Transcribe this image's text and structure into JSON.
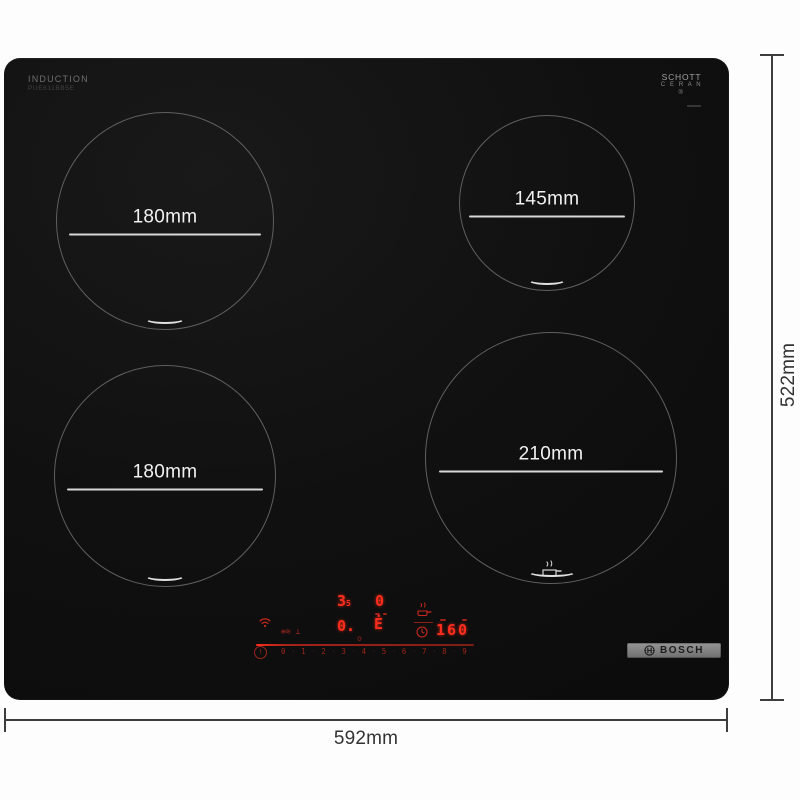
{
  "branding": {
    "induction": "INDUCTION",
    "model": "PUE611BB5E",
    "schott_line1": "SCHOTT",
    "schott_line2": "C E R A N ®",
    "bosch": "BOSCH"
  },
  "dimensions": {
    "width_label": "592mm",
    "height_label": "522mm"
  },
  "zones": [
    {
      "position": "top-left",
      "label": "180mm"
    },
    {
      "position": "top-right",
      "label": "145mm"
    },
    {
      "position": "bottom-left",
      "label": "180mm"
    },
    {
      "position": "bottom-right",
      "label": "210mm"
    }
  ],
  "display": {
    "burner_a_value": "3",
    "burner_a_sub": "5",
    "burner_b_value": "0",
    "burner_c_value": "0.",
    "burner_c_sub": "o",
    "burner_d_glyph": "Ė",
    "timer_value": "160",
    "power_symbol": "!",
    "dot": "·",
    "keepwarm_glyphs": "≡≋ ⊥",
    "slider": [
      "0",
      "1",
      "2",
      "3",
      "4",
      "5",
      "6",
      "7",
      "8",
      "9"
    ],
    "led_color": "#ff2d1e",
    "led_dim_color": "#93241a"
  }
}
